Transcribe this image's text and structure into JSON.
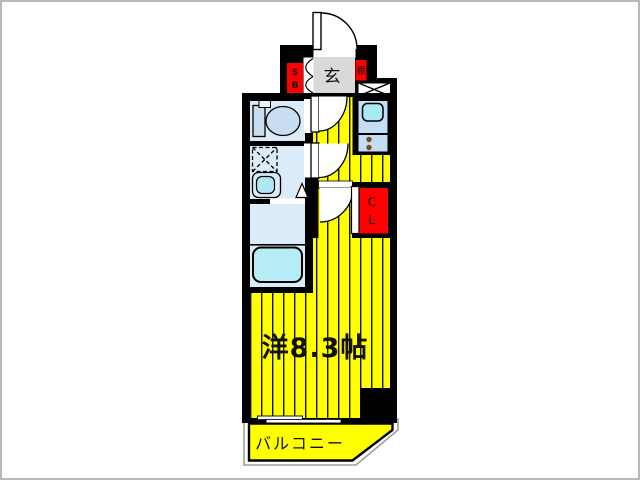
{
  "floor_plan": {
    "labels": {
      "main_room": "洋8.3帖",
      "balcony": "バルコニー",
      "entrance": "玄",
      "shelf": "棚",
      "shoe_box": [
        "S",
        "B"
      ],
      "closet": [
        "C",
        "L"
      ]
    },
    "colors": {
      "wall": "#000000",
      "room_floor_yellow": "#ffff00",
      "wet_area_floor": "#dcebf8",
      "fixture_blue": "#c8ddf0",
      "water_cyan": "#aee8f2",
      "bathtub_cyan": "#b5ecf5",
      "entrance_floor_gray": "#d9d9d9",
      "storage_red": "#ff0000",
      "stove_burner_brown": "#7b4b1d",
      "outer_border_gray": "#b9b9b9"
    }
  }
}
